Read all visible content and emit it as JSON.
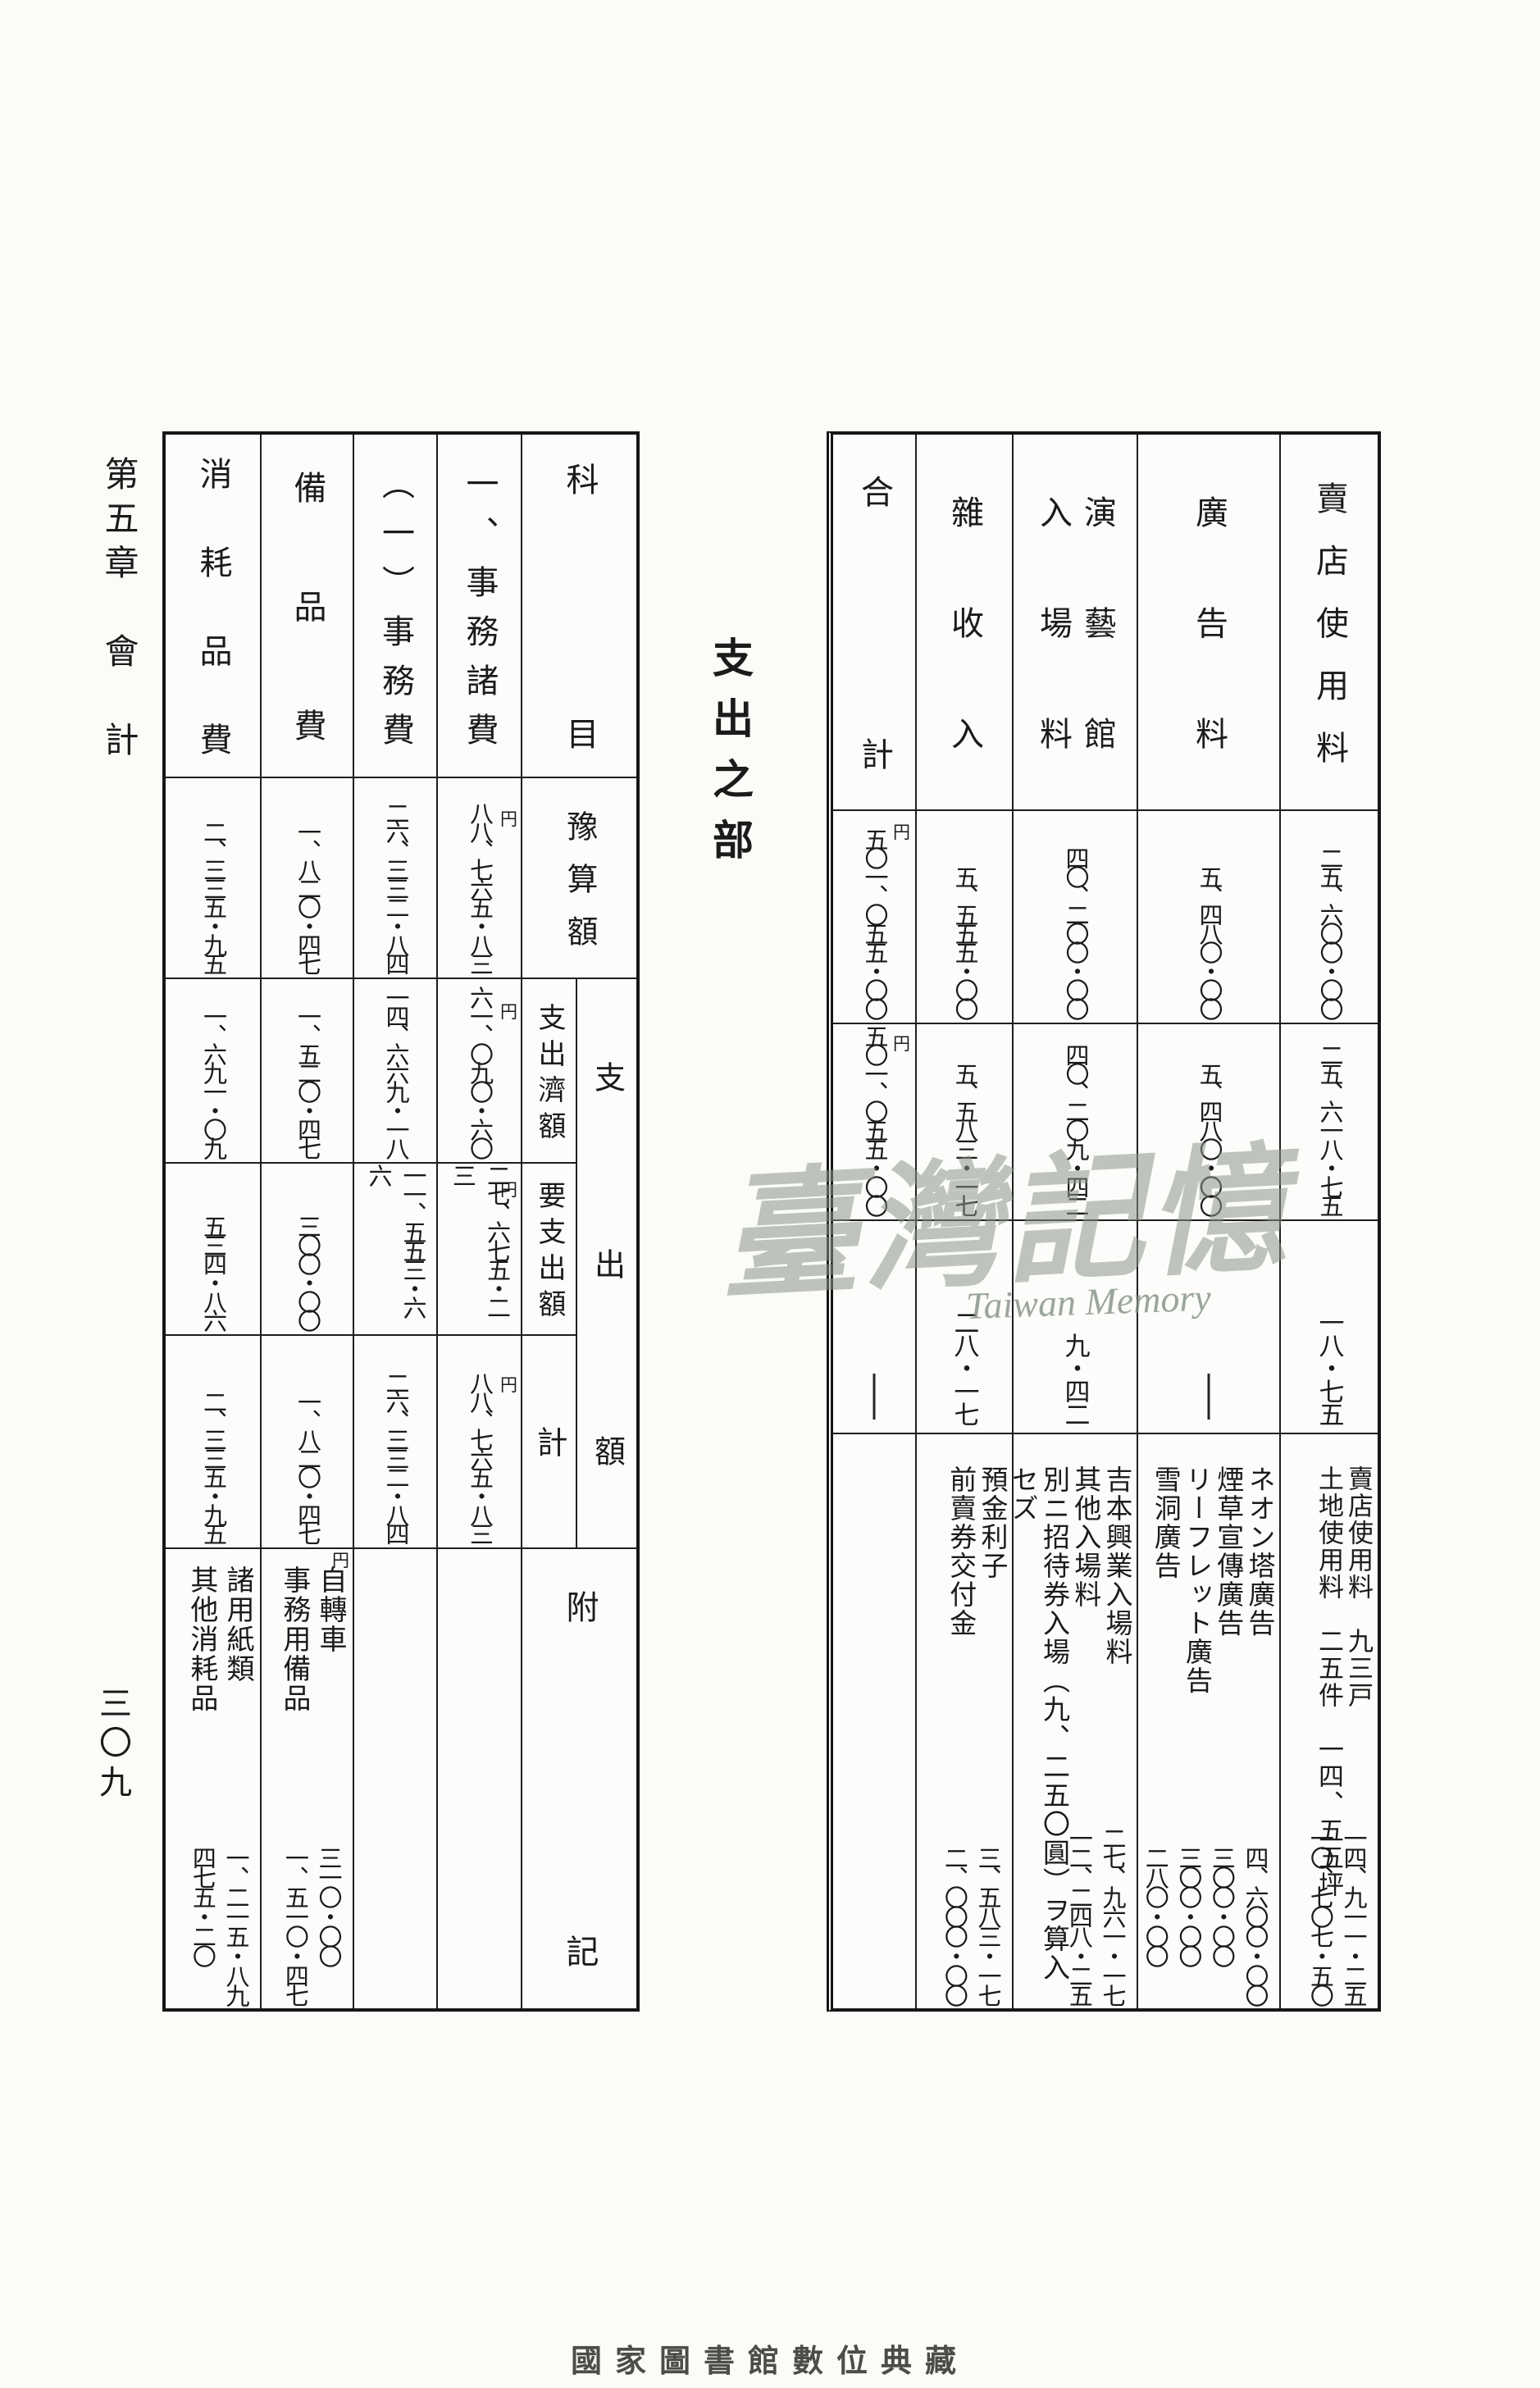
{
  "page": {
    "chapter_title": "第五章　會　計",
    "page_number": "三〇九",
    "section_title": "支出之部",
    "watermark_cjk": "臺灣記憶",
    "watermark_latin": "Taiwan Memory",
    "footer_credit": "國家圖書館數位典藏",
    "unit_yen": "円"
  },
  "income_table": {
    "columns": [
      {
        "label": "賣店使用料",
        "budget": "二五、六〇〇・〇〇",
        "received": "二五、六一八・七五",
        "excess": "一八・七五",
        "note_lines": "賣店使用料　九三戸\n土地使用料　二五件　一四、五五坪",
        "note_amounts": "一四、九一一・二五\n一〇、七〇七・五〇"
      },
      {
        "label": "廣告料",
        "budget": "五、四八〇・〇〇",
        "received": "五、四八〇・〇〇",
        "excess": "—",
        "note_lines": "ネオン塔廣告\n煙草宣傳廣告\nリーフレット廣告\n雪洞廣告",
        "note_amounts": "四、六〇〇・〇〇\n三〇〇・〇〇\n三〇〇・〇〇\n二八〇・〇〇"
      },
      {
        "label": "演藝館\n入場料",
        "budget": "四〇、二〇〇・〇〇",
        "received": "四〇、二〇九・四二",
        "excess": "九・四二",
        "note_lines": "吉本興業入場料\n其他入場料\n別ニ招待券入場（九、二五〇圓）ヲ算入セズ",
        "note_amounts": "二七、九六一・一七\n一二、二四八・二五"
      },
      {
        "label": "雜收入",
        "budget": "五、五五五・〇〇",
        "received": "五、五八三・一七",
        "excess": "二八・一七",
        "note_lines": "預金利子\n前賣券交付金",
        "note_amounts": "三、五八三・一七\n二、〇〇〇・〇〇"
      },
      {
        "label": "合計",
        "budget": "五〇一、〇五五・〇〇",
        "received": "五〇一、〇五五・〇〇",
        "excess": "—",
        "note_lines": "",
        "note_amounts": ""
      }
    ]
  },
  "expense_table": {
    "header_col": {
      "title": "科目",
      "budget": "豫算額",
      "group": "支出額",
      "paid": "支出濟額",
      "to_pay": "要支出額",
      "total": "計",
      "notes": "附記"
    },
    "columns": [
      {
        "label": "一、事務諸費",
        "budget": "八八、七六五・八三",
        "paid": "六一、〇九〇・六〇",
        "to_pay": "二七、六七五・二三",
        "total": "八八、七六五・八三",
        "note_lines": "",
        "note_amounts": ""
      },
      {
        "label": "（一）事務費",
        "budget": "二六、三三二・八四",
        "paid": "一四、六六九・一八",
        "to_pay": "一一、五五三・六六",
        "total": "二六、三三二・八四",
        "note_lines": "",
        "note_amounts": ""
      },
      {
        "label": "備品費",
        "budget": "一、八二〇・四七",
        "paid": "一、五二〇・四七",
        "to_pay": "三〇〇・〇〇",
        "total": "一、八二〇・四七",
        "note_lines": "自轉車\n事務用備品",
        "note_amounts": "三一〇・〇〇\n一、五一〇・四七"
      },
      {
        "label": "消耗品費",
        "budget": "二、三三五・九五",
        "paid": "一、六九一・〇九",
        "to_pay": "五三四・八六",
        "total": "二、三三五・九五",
        "note_lines": "諸用紙類\n其他消耗品",
        "note_amounts": "一、二一五・八九\n四七五・二〇"
      }
    ]
  }
}
